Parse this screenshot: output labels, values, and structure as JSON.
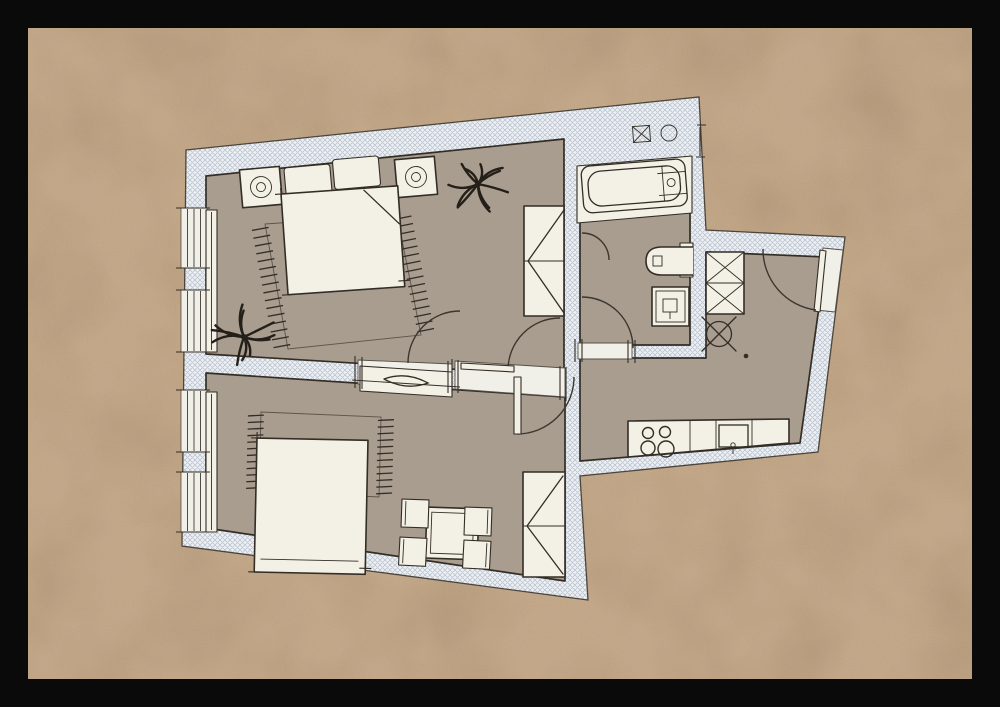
{
  "document": {
    "kind": "hand-drawn apartment floor plan",
    "style": "watercolor and ink sketch on tan paper with black frame",
    "visible_text": "none"
  },
  "palette": {
    "frame": "#0a0a0a",
    "paper": "#c3a88a",
    "wallbase": "#edf0f3",
    "hatchline": "#b4bfcc",
    "floor": "#a89d8f",
    "furn": "#f3f1e6",
    "gap": "#f0efe8",
    "ink": "#332d26"
  },
  "rooms": [
    {
      "name": "bedroom-top",
      "contents": [
        "double-bed",
        "two-pillows",
        "nightstand-with-lamp-left",
        "nightstand-with-lamp-right",
        "fringed-rug",
        "wardrobe",
        "plant-top-right",
        "plant-bottom-left",
        "double-door-to-lower-room"
      ]
    },
    {
      "name": "bedroom-bottom",
      "contents": [
        "bed",
        "fringed-rug",
        "dining-table",
        "four-chairs",
        "wardrobe",
        "sideboard-radiator-in-wall-niche"
      ]
    },
    {
      "name": "bathroom",
      "contents": [
        "bathtub",
        "toilet",
        "washing-machine",
        "vent-symbol-boxed-x",
        "vent-symbol-circle",
        "door-to-hall",
        "small-swing-panel"
      ]
    },
    {
      "name": "entry-hall-kitchen",
      "contents": [
        "entrance-door",
        "hall-wardrobe",
        "ceiling-light",
        "kitchen-counter",
        "cooktop-4-burners",
        "kitchen-sink"
      ]
    }
  ],
  "windows": {
    "x": 181,
    "w": 26,
    "glazing_x": [
      187.5,
      194,
      200.5
    ],
    "sashes": [
      [
        208,
        268
      ],
      [
        290,
        352
      ],
      [
        390,
        452
      ],
      [
        472,
        532
      ]
    ]
  },
  "rugs": [
    {
      "name": "rug-bedroom-top",
      "outline": [
        [
          265,
          224
        ],
        [
          397,
          215
        ],
        [
          421,
          335
        ],
        [
          288,
          349
        ]
      ],
      "fringes": [
        {
          "from": [
            265,
            224
          ],
          "to": [
            288,
            349
          ],
          "ticks": 16,
          "dir": [
            -0.984,
            0.18
          ],
          "len": 14
        },
        {
          "from": [
            397,
            215
          ],
          "to": [
            421,
            335
          ],
          "ticks": 16,
          "dir": [
            0.981,
            -0.196
          ],
          "len": 14
        }
      ]
    },
    {
      "name": "rug-bedroom-bottom",
      "outline": [
        [
          261,
          412
        ],
        [
          381,
          417
        ],
        [
          379,
          497
        ],
        [
          259,
          491
        ]
      ],
      "fringes": [
        {
          "from": [
            261,
            412
          ],
          "to": [
            259,
            491
          ],
          "ticks": 12,
          "dir": [
            -1,
            0.05
          ],
          "len": 13
        },
        {
          "from": [
            381,
            417
          ],
          "to": [
            379,
            497
          ],
          "ticks": 12,
          "dir": [
            1,
            -0.05
          ],
          "len": 13
        }
      ]
    }
  ],
  "plants": [
    {
      "name": "plant-top-right",
      "x": 478,
      "y": 184,
      "r": 31,
      "leaves": 11,
      "seed": 2
    },
    {
      "name": "plant-bottom-left",
      "x": 244,
      "y": 337,
      "r": 33,
      "leaves": 11,
      "seed": 5
    }
  ],
  "kitchen": {
    "burners": [
      [
        648,
        433,
        5.5
      ],
      [
        665,
        432,
        5.5
      ],
      [
        648,
        448,
        7
      ],
      [
        666,
        449,
        8
      ]
    ]
  },
  "symbols": [
    {
      "name": "vent-boxed-x",
      "x": 641,
      "y": 134
    },
    {
      "name": "vent-circle",
      "x": 669,
      "y": 133,
      "r": 8
    },
    {
      "name": "ceiling-light",
      "x": 719,
      "y": 334,
      "r": 12.5
    }
  ]
}
